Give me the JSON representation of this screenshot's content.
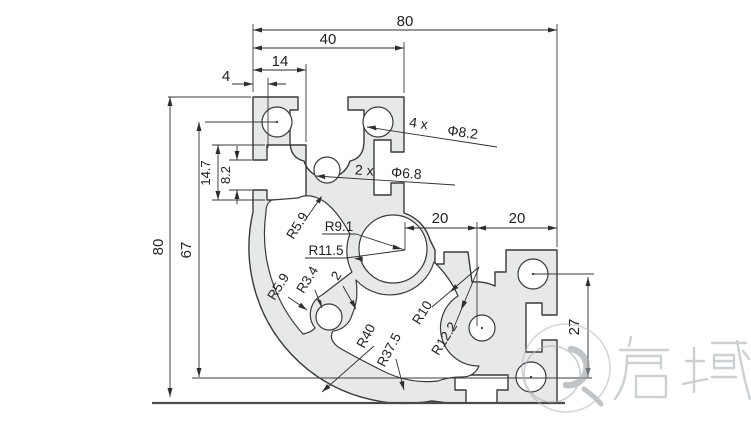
{
  "title": "8080R aluminium profile cross-section drawing",
  "dims": {
    "top_overall": "80",
    "top_arm_width": "40",
    "slot_depth": "14",
    "slot_lip": "4",
    "left_overall": "80",
    "hole_span_vertical": "67",
    "slot_height": "14.7",
    "slot_opening": "8.2",
    "right_pitch_a": "20",
    "right_pitch_b": "20",
    "hole_span_right": "27"
  },
  "callouts": {
    "corner_hole_count": "4 x",
    "corner_hole_dia": "Φ8.2",
    "center_hole_count": "2 x",
    "center_hole_dia": "Φ6.8"
  },
  "radii": {
    "web_fillet_upper": "R5.9",
    "ring_inner": "R9.1",
    "ring_outer": "R11.5",
    "keyhole_inner": "R3.4",
    "wall_thickness": "2",
    "keyhole_outer": "R5.9",
    "outer_corner": "R40",
    "inner_corner": "R37.5",
    "boss_inner": "R10",
    "boss_outer": "R12.2"
  },
  "watermark": {
    "brand": "启域"
  },
  "colors": {
    "profile_fill": "#e7e8e8",
    "line": "#3a3a3a",
    "dimension": "#2e2e2e",
    "watermark": "#b2b8bb"
  }
}
